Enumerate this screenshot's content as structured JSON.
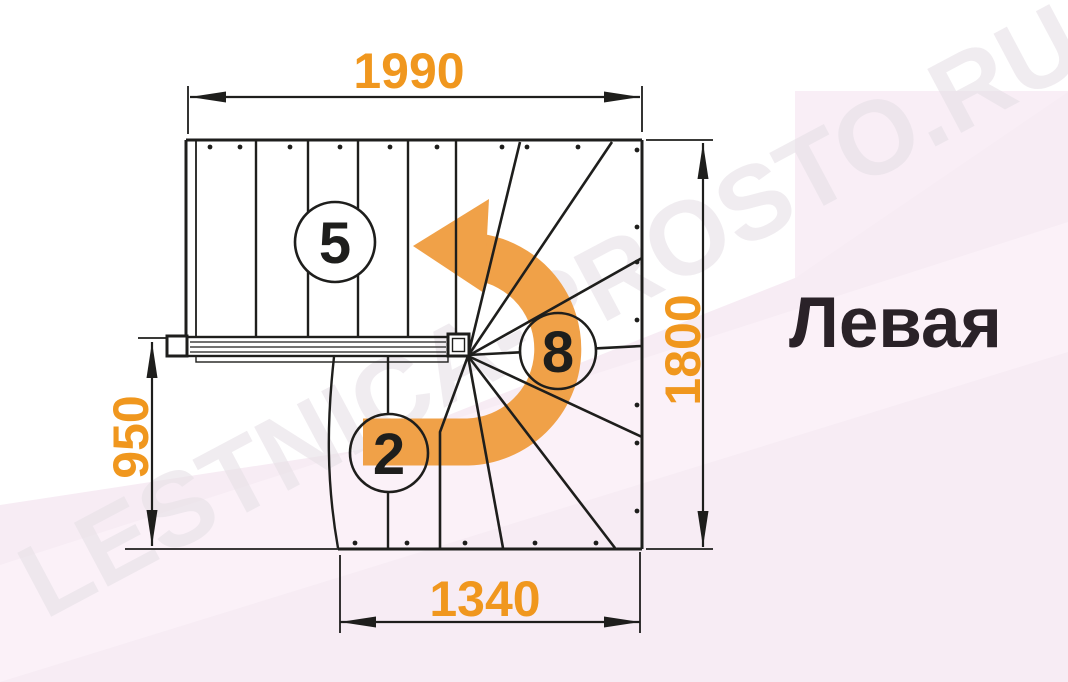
{
  "title_label": "Левая",
  "watermark": "LESTNICA-PROSTO.RU",
  "dims": {
    "top": "1990",
    "right": "1800",
    "left": "950",
    "bottom": "1340"
  },
  "steps": {
    "upper_flight": "5",
    "winder": "8",
    "lower_flight": "2"
  },
  "colors": {
    "dimension_orange": "#F0971E",
    "arrow_orange": "#F0A148",
    "line_black": "#1E1E1C",
    "background_pink": "#F7ECF4",
    "background_pink_light": "#FBF3F9",
    "watermark_gray": "#E7E1E7",
    "title_black": "#2A2228"
  }
}
